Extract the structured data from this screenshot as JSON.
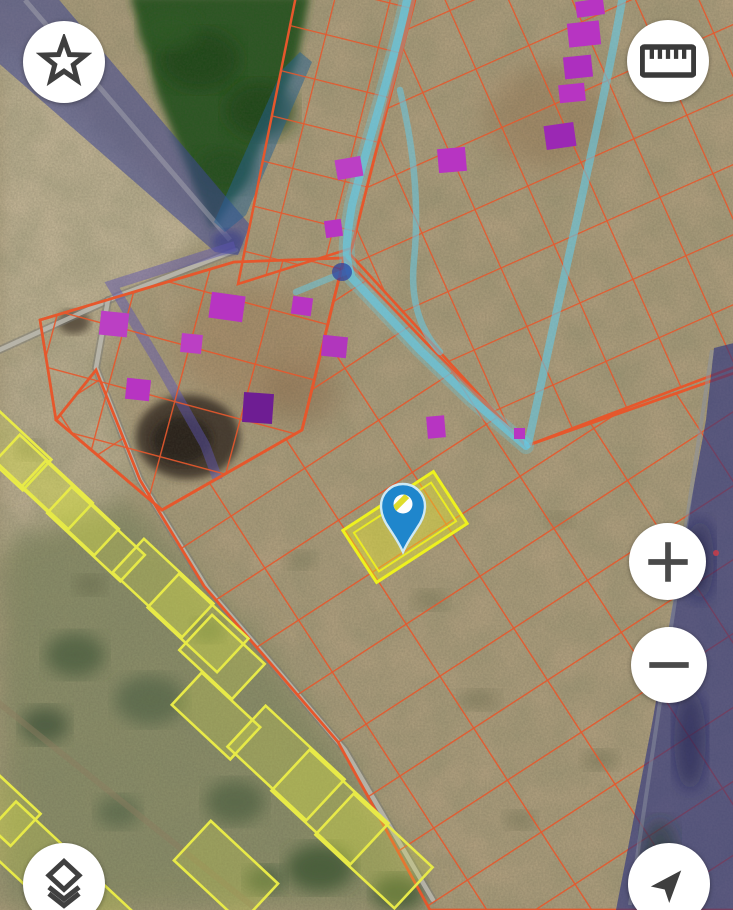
{
  "view": {
    "width": 733,
    "height": 910,
    "type": "satellite-parcel-map"
  },
  "controls": {
    "favorite": {
      "icon": "star-icon",
      "label": "favorite"
    },
    "measure": {
      "icon": "ruler-icon",
      "label": "measure"
    },
    "zoom_in": {
      "icon": "plus-icon",
      "label": "zoom-in"
    },
    "zoom_out": {
      "icon": "minus-icon",
      "label": "zoom-out"
    },
    "layers": {
      "icon": "layers-icon",
      "label": "layers"
    },
    "my_location": {
      "icon": "navigation-arrow-icon",
      "label": "my-location"
    }
  },
  "colors": {
    "parcel_boundary": "#e6572c",
    "yellow_parcel_boundary": "#e8ea48",
    "selected_parcel": "#eef21e",
    "building_highlight": "#b734c2",
    "marker": "#1f86cc",
    "stream_overlay": "#64c9e6",
    "road_overlay": "#3c468f",
    "button_background": "#ffffff",
    "icon": "#3f3f3f"
  },
  "map": {
    "marker": {
      "x": 403,
      "y": 552
    },
    "selected_parcel": {
      "cx": 405,
      "cy": 527,
      "w": 108,
      "h": 62,
      "rot": -33
    },
    "buildings": [
      {
        "x": 576,
        "y": 0,
        "w": 28,
        "h": 16,
        "rot": -8
      },
      {
        "x": 568,
        "y": 22,
        "w": 32,
        "h": 24,
        "rot": -6
      },
      {
        "x": 564,
        "y": 56,
        "w": 28,
        "h": 22,
        "rot": -6,
        "c": "#ad2fbf"
      },
      {
        "x": 559,
        "y": 84,
        "w": 26,
        "h": 18,
        "rot": -6
      },
      {
        "x": 545,
        "y": 124,
        "w": 30,
        "h": 24,
        "rot": -8,
        "c": "#9b28b4"
      },
      {
        "x": 438,
        "y": 148,
        "w": 28,
        "h": 24,
        "rot": -5
      },
      {
        "x": 336,
        "y": 158,
        "w": 26,
        "h": 20,
        "rot": -10,
        "c": "#bb3fc4"
      },
      {
        "x": 325,
        "y": 220,
        "w": 17,
        "h": 17,
        "rot": -8
      },
      {
        "x": 427,
        "y": 416,
        "w": 18,
        "h": 22,
        "rot": -5
      },
      {
        "x": 100,
        "y": 312,
        "w": 28,
        "h": 24,
        "rot": 6,
        "c": "#bb3fc4"
      },
      {
        "x": 210,
        "y": 294,
        "w": 34,
        "h": 26,
        "rot": 8
      },
      {
        "x": 292,
        "y": 297,
        "w": 20,
        "h": 18,
        "rot": 8
      },
      {
        "x": 181,
        "y": 334,
        "w": 21,
        "h": 19,
        "rot": 6,
        "c": "#bb3fc4"
      },
      {
        "x": 126,
        "y": 379,
        "w": 24,
        "h": 21,
        "rot": 6
      },
      {
        "x": 243,
        "y": 393,
        "w": 30,
        "h": 30,
        "rot": 4,
        "c": "#6e1d93"
      },
      {
        "x": 322,
        "y": 336,
        "w": 25,
        "h": 21,
        "rot": 6,
        "c": "#b136bd"
      },
      {
        "x": 514,
        "y": 428,
        "w": 11,
        "h": 11,
        "rot": 0
      }
    ],
    "yellow_parcels": [
      {
        "cx": 6,
        "cy": 446,
        "w": 85,
        "h": 42,
        "rot": 43
      },
      {
        "cx": 44,
        "cy": 482,
        "w": 100,
        "h": 36,
        "rot": 43
      },
      {
        "cx": 70,
        "cy": 508,
        "w": 100,
        "h": 36,
        "rot": 43
      },
      {
        "cx": 96,
        "cy": 534,
        "w": 100,
        "h": 36,
        "rot": 43
      },
      {
        "cx": 163,
        "cy": 588,
        "w": 95,
        "h": 46,
        "rot": 43
      },
      {
        "cx": 198,
        "cy": 623,
        "w": 95,
        "h": 46,
        "rot": 43
      },
      {
        "cx": 222,
        "cy": 657,
        "w": 72,
        "h": 48,
        "rot": 43
      },
      {
        "cx": 216,
        "cy": 716,
        "w": 80,
        "h": 44,
        "rot": 43
      },
      {
        "cx": 286,
        "cy": 763,
        "w": 108,
        "h": 56,
        "rot": 43
      },
      {
        "cx": 330,
        "cy": 807,
        "w": 108,
        "h": 56,
        "rot": 43
      },
      {
        "cx": 374,
        "cy": 851,
        "w": 108,
        "h": 56,
        "rot": 43
      },
      {
        "cx": 226,
        "cy": 872,
        "w": 92,
        "h": 54,
        "rot": 43
      },
      {
        "cx": 32,
        "cy": 854,
        "w": 95,
        "h": 55,
        "rot": 43
      },
      {
        "cx": 80,
        "cy": 900,
        "w": 95,
        "h": 55,
        "rot": 43
      },
      {
        "cx": 0,
        "cy": 806,
        "w": 70,
        "h": 44,
        "rot": 43
      }
    ]
  }
}
